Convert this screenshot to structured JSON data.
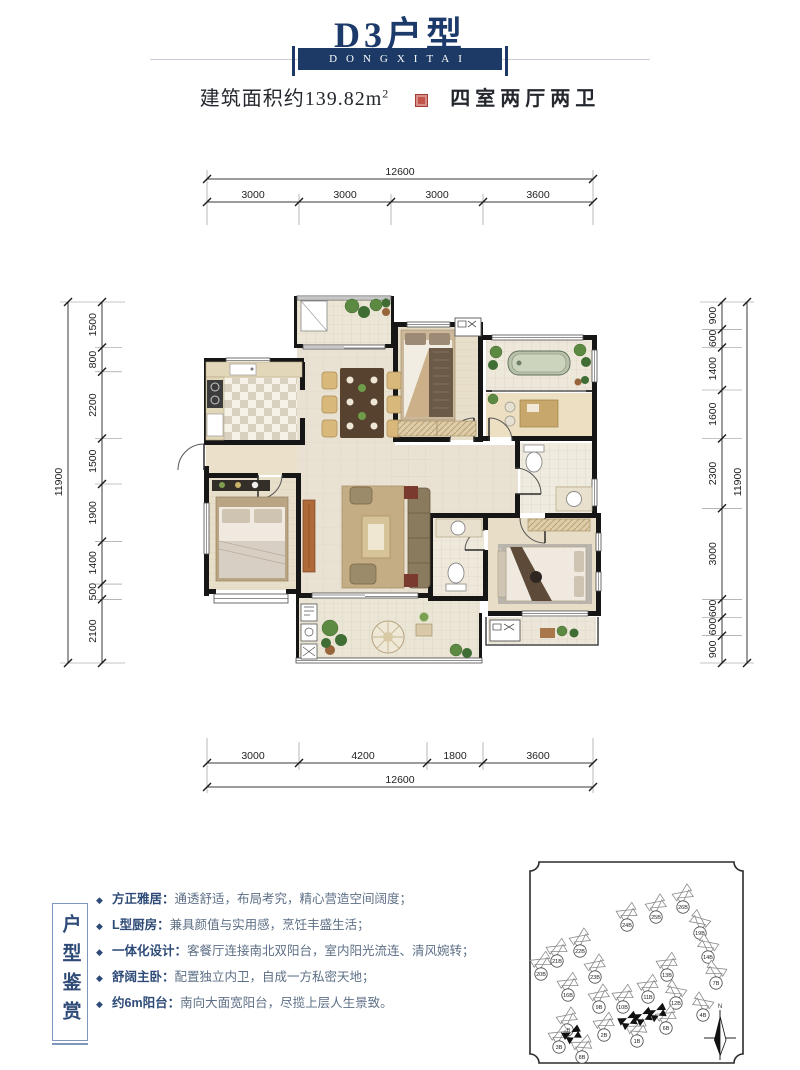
{
  "header": {
    "title": "D3户型",
    "banner": "DONGXITAI",
    "area_label": "建筑面积约139.82m",
    "area_sup": "2",
    "layout_label": "四室两厅两卫",
    "navy": "#1d3a66",
    "seal_color": "#c2544a"
  },
  "plan": {
    "dims": {
      "top": {
        "total": "12600",
        "segments": [
          "3000",
          "3000",
          "3000",
          "3600"
        ]
      },
      "bottom": {
        "total": "12600",
        "segments": [
          "3000",
          "4200",
          "1800",
          "3600"
        ]
      },
      "left": {
        "total": "11900",
        "segments": [
          "1500",
          "800",
          "2200",
          "1500",
          "1900",
          "1400",
          "500",
          "2100"
        ]
      },
      "right": {
        "total": "11900",
        "segments": [
          "900",
          "600",
          "1400",
          "1600",
          "2300",
          "3000",
          "600",
          "600",
          "900"
        ]
      }
    }
  },
  "features": {
    "box_title": "户型鉴赏",
    "items": [
      {
        "label": "方正雅居：",
        "text": "通透舒适，布局考究，精心营造空间阔度；"
      },
      {
        "label": "L型厨房：",
        "text": "兼具颜值与实用感，烹饪丰盛生活；"
      },
      {
        "label": "一体化设计：",
        "text": "客餐厅连接南北双阳台，室内阳光流连、清风婉转；"
      },
      {
        "label": "舒阔主卧：",
        "text": "配置独立内卫，自成一方私密天地；"
      },
      {
        "label": "约6m阳台：",
        "text": "南向大面宽阳台，尽揽上层人生景致。"
      }
    ]
  },
  "siteplan": {
    "compass_label": "N",
    "buildings": [
      {
        "x": 683,
        "y": 894,
        "rot": -35,
        "label": "26B"
      },
      {
        "x": 656,
        "y": 904,
        "rot": -35,
        "label": "25B"
      },
      {
        "x": 627,
        "y": 912,
        "rot": -30,
        "label": "24B"
      },
      {
        "x": 700,
        "y": 920,
        "rot": 40,
        "label": "19B"
      },
      {
        "x": 580,
        "y": 938,
        "rot": -35,
        "label": "22B"
      },
      {
        "x": 557,
        "y": 948,
        "rot": -30,
        "label": "21B"
      },
      {
        "x": 708,
        "y": 944,
        "rot": 35,
        "label": "14B"
      },
      {
        "x": 541,
        "y": 961,
        "rot": -30,
        "label": "20B"
      },
      {
        "x": 595,
        "y": 964,
        "rot": -35,
        "label": "23B"
      },
      {
        "x": 667,
        "y": 962,
        "rot": -30,
        "label": "13B"
      },
      {
        "x": 716,
        "y": 970,
        "rot": 30,
        "label": "7B"
      },
      {
        "x": 568,
        "y": 982,
        "rot": -30,
        "label": "16B"
      },
      {
        "x": 648,
        "y": 984,
        "rot": -30,
        "label": "11B"
      },
      {
        "x": 676,
        "y": 990,
        "rot": 35,
        "label": "12B"
      },
      {
        "x": 599,
        "y": 994,
        "rot": -35,
        "label": "9B"
      },
      {
        "x": 623,
        "y": 994,
        "rot": -30,
        "label": "10B"
      },
      {
        "x": 703,
        "y": 1002,
        "rot": 35,
        "label": "4B"
      },
      {
        "x": 666,
        "y": 1015,
        "rot": -30,
        "label": "6B"
      },
      {
        "x": 567,
        "y": 1017,
        "rot": -35,
        "label": "5B"
      },
      {
        "x": 604,
        "y": 1022,
        "rot": -30,
        "label": "2B"
      },
      {
        "x": 637,
        "y": 1028,
        "rot": -25,
        "label": "1B"
      },
      {
        "x": 559,
        "y": 1034,
        "rot": -30,
        "label": "3B"
      },
      {
        "x": 582,
        "y": 1044,
        "rot": -25,
        "label": "8B"
      },
      {
        "x": 628,
        "y": 1020,
        "rot": -25,
        "label": "",
        "hl": true
      },
      {
        "x": 643,
        "y": 1016,
        "rot": -25,
        "label": "",
        "hl": true
      },
      {
        "x": 657,
        "y": 1012,
        "rot": -25,
        "label": "",
        "hl": true
      },
      {
        "x": 572,
        "y": 1034,
        "rot": -28,
        "label": "",
        "hl": true
      }
    ]
  }
}
